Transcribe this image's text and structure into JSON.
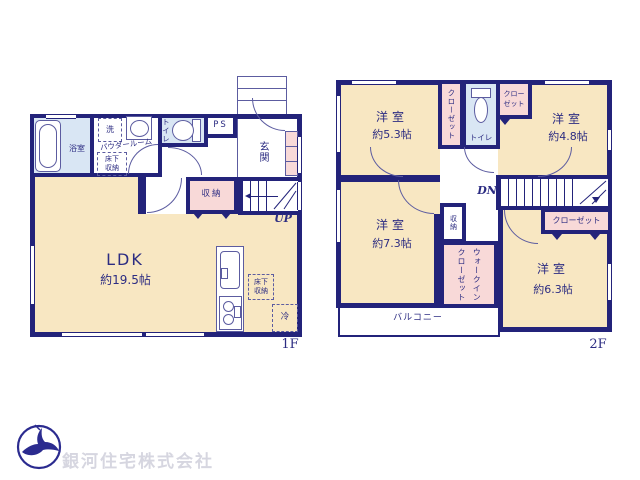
{
  "colors": {
    "wall": "#23237a",
    "room": "#f8e7c2",
    "closet": "#f8d9d8",
    "wet": "#d9e6f4",
    "text": "#2c2c82",
    "line": "#5c5ca0",
    "logo": "#2b2b8f",
    "logo_text": "#d6d6e0"
  },
  "floor1": {
    "floor_label": "1F",
    "bath": {
      "label": "浴室"
    },
    "powder": {
      "label": "パウダールーム",
      "washer": "洗",
      "underfloor": "床下\n収納"
    },
    "toilet": {
      "label": "トイレ"
    },
    "ps": {
      "label": "PS"
    },
    "entrance": {
      "label": "玄関"
    },
    "storage": {
      "label": "収納"
    },
    "stairs": {
      "label": "UP"
    },
    "ldk": {
      "label": "LDK",
      "size": "約19.5帖"
    },
    "kitchen": {
      "underfloor": "床下\n収納",
      "fridge": "冷"
    }
  },
  "floor2": {
    "floor_label": "2F",
    "room_nw": {
      "label": "洋室",
      "size": "約5.3帖"
    },
    "closet_nw": {
      "label": "クローゼット"
    },
    "toilet": {
      "label": "トイレ"
    },
    "closet_ne": {
      "label": "クロー\nゼット"
    },
    "room_ne": {
      "label": "洋室",
      "size": "約4.8帖"
    },
    "stairs": {
      "label": "DN"
    },
    "room_sw": {
      "label": "洋室",
      "size": "約7.3帖"
    },
    "storage": {
      "label": "収納"
    },
    "wic": {
      "label": "ウォークイン\nクローゼット"
    },
    "closet_se": {
      "label": "クローゼット"
    },
    "room_se": {
      "label": "洋室",
      "size": "約6.3帖"
    },
    "balcony": {
      "label": "バルコニー"
    }
  },
  "company": {
    "name": "銀河住宅株式会社"
  }
}
